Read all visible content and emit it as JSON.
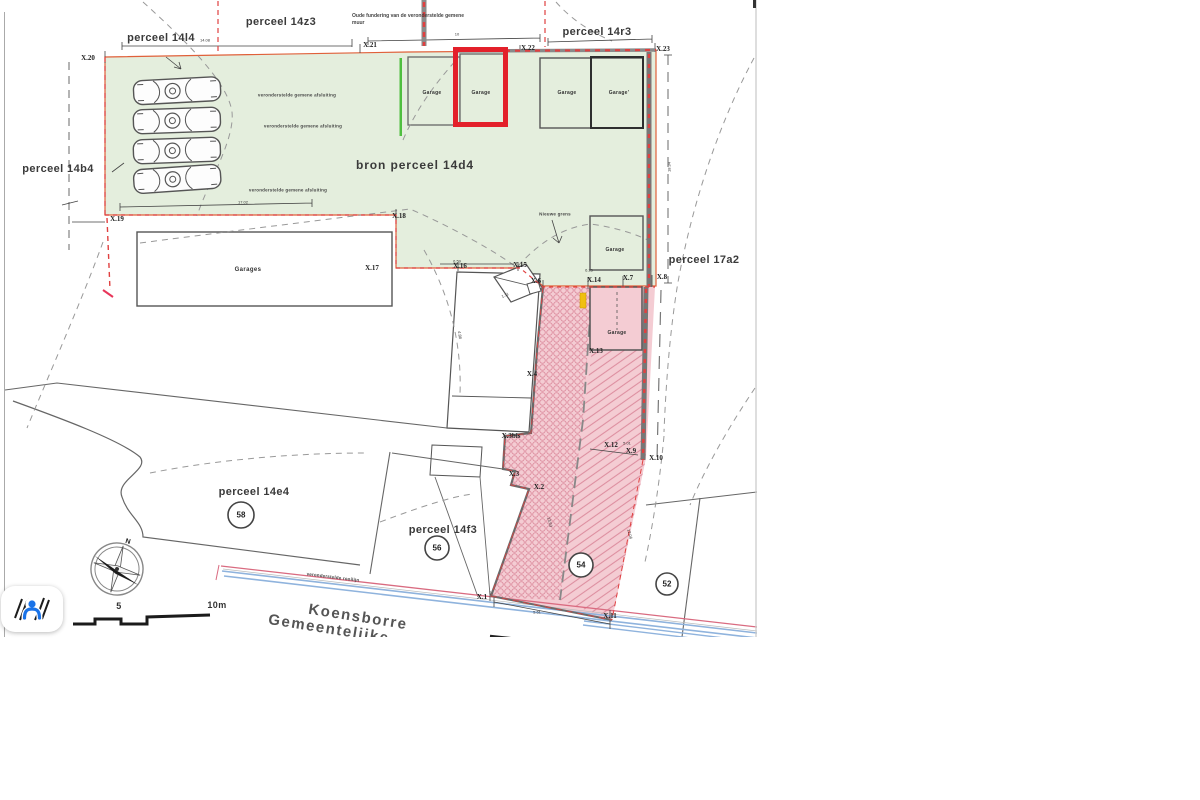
{
  "plan": {
    "parcels": {
      "p14l4": "perceel 14l4",
      "p14z3": "perceel 14z3",
      "p14r3": "perceel 14r3",
      "p14b4": "perceel 14b4",
      "bron": "bron perceel 14d4",
      "p17a2": "perceel 17a2",
      "p14e4": "perceel 14e4",
      "p14f3": "perceel 14f3"
    },
    "notes": {
      "oude_fundering": "Oude fundering van de veronderstelde gemene muur",
      "afsluiting": "veronderstelde gemene afsluiting",
      "nieuwe_grens": "Nieuwe grens",
      "rooilijn": "veronderstelde rooilijn"
    },
    "street": {
      "name": "Koensborre",
      "type": "Gemeentelijke"
    },
    "survey_points": {
      "x1": "X.1",
      "x2": "X.2",
      "x3": "X.3",
      "x3bis": "X.3bis",
      "x4": "X.4",
      "x6": "X.6",
      "x7": "X.7",
      "x8": "X.8",
      "x9": "X.9",
      "x10": "X.10",
      "x11": "X.11",
      "x12": "X.12",
      "x13": "X.13",
      "x14": "X.14",
      "x15": "X.15",
      "x16": "X.16",
      "x17": "X.17",
      "x18": "X.18",
      "x19": "X.19",
      "x20": "X.20",
      "x21": "X.21",
      "x22": "X.22",
      "x23": "X.23"
    },
    "garages": {
      "single": "Garage",
      "prime": "Garage'",
      "plural": "Garages"
    },
    "lot_numbers": {
      "n58": "58",
      "n56": "56",
      "n54": "54",
      "n52": "52"
    },
    "dimensions": {
      "d1408": "14.08",
      "d10": "10",
      "d1702": "17.02",
      "d1834": "18.34",
      "d659": "6.59",
      "d625": "6.25",
      "d501": "5.01",
      "d111": "1.11",
      "d561": "5.61",
      "d1353": "13.53",
      "d1206": "12.06",
      "d488": "4.88"
    },
    "scale": {
      "mid": "5",
      "end": "10m"
    },
    "compass": {
      "north": "N"
    },
    "colors": {
      "highlight_red": "#e3202a",
      "green_fill": "#e4eedd",
      "pink_fill": "#f4ccd3",
      "hatch_pink": "#dd8fa0",
      "marker_yellow": "#f0c010",
      "street_blue": "#8fb3dd",
      "boundary_orange": "#e0603a",
      "boundary_red_dash": "#e04040",
      "icon_blue": "#1a73e8"
    }
  }
}
